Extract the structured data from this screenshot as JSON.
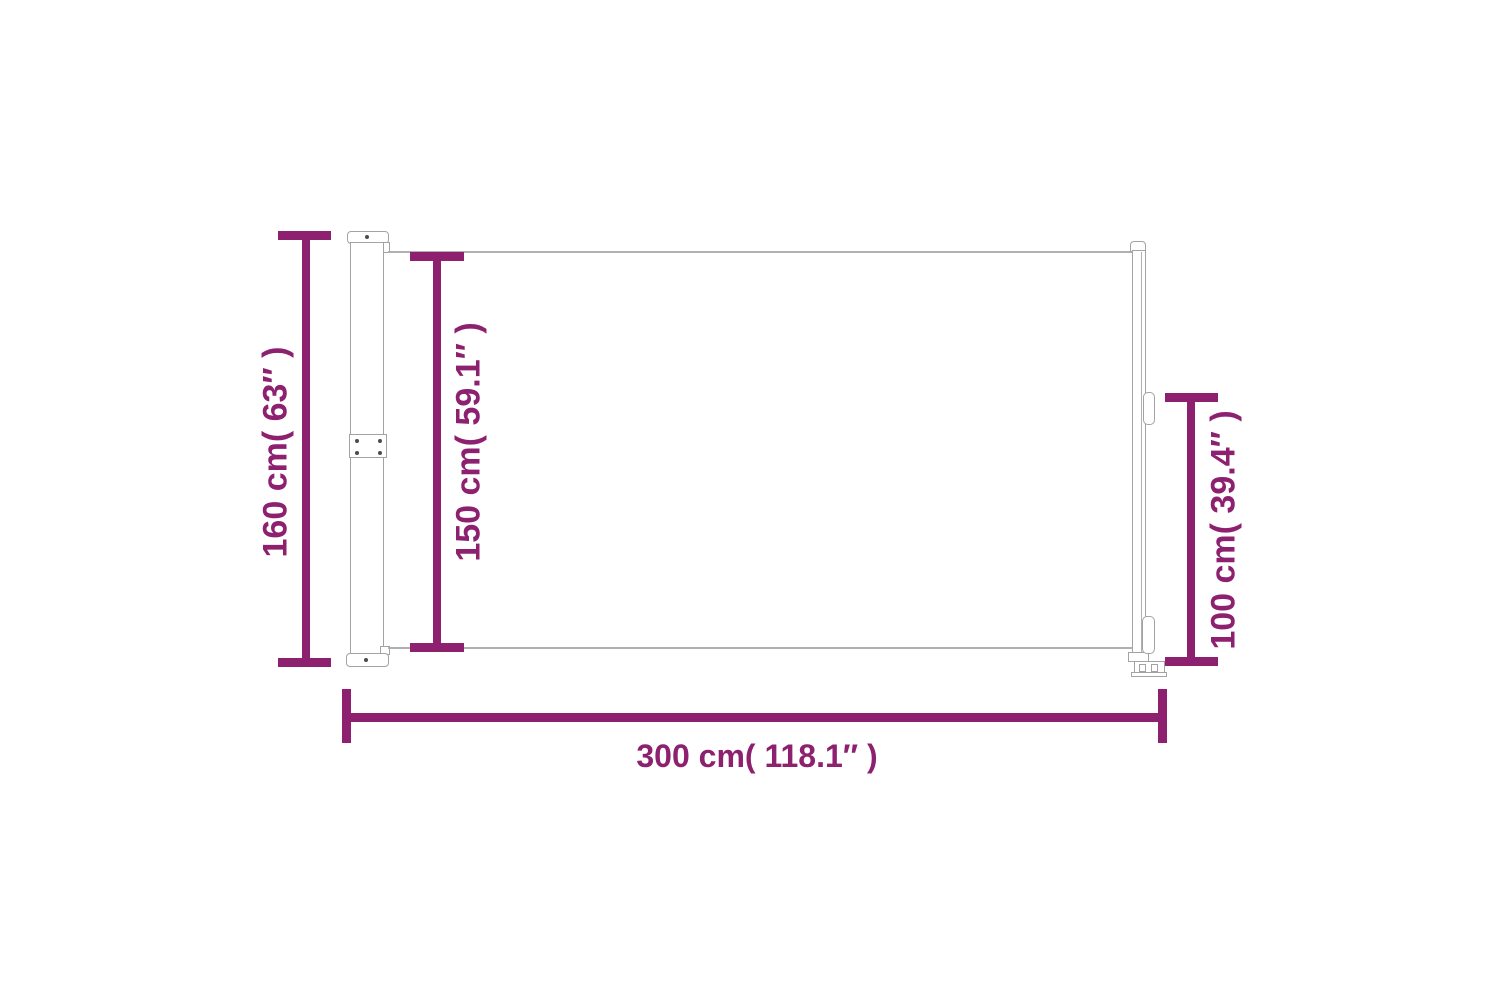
{
  "colors": {
    "accent": "#8d2170",
    "product_outline": "#a3a3a3",
    "background": "#ffffff"
  },
  "dimensions": {
    "total_height": {
      "cm": 160,
      "inches": 63,
      "label": "160 cm( 63″ )"
    },
    "screen_height": {
      "cm": 150,
      "inches": 59.1,
      "label": "150 cm( 59.1″ )"
    },
    "pull_bar_height": {
      "cm": 100,
      "inches": 39.4,
      "label": "100 cm( 39.4″ )"
    },
    "total_width": {
      "cm": 300,
      "inches": 118.1,
      "label": "300 cm( 118.1″ )"
    }
  }
}
